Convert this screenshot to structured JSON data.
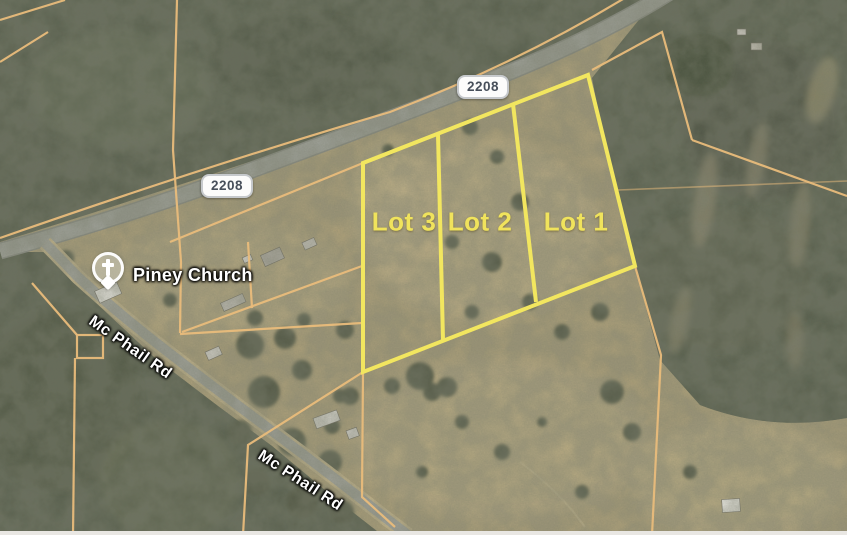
{
  "map": {
    "highway_badges": [
      {
        "label": "2208"
      },
      {
        "label": "2208"
      }
    ],
    "place": {
      "label": "Piney Church",
      "icon": "church-pin-icon"
    },
    "road_labels": [
      {
        "label": "Mc Phail Rd"
      },
      {
        "label": "Mc Phail Rd"
      }
    ],
    "lot_labels": [
      {
        "label": "Lot 3"
      },
      {
        "label": "Lot 2"
      },
      {
        "label": "Lot 1"
      }
    ],
    "colors": {
      "lot-line": "#f2e65f",
      "lot-text": "#f0e35c",
      "parcel-line": "#e9bc7b",
      "road-gray": "#a1a39b",
      "road-casing": "#8b8d85",
      "dirt-casing": "#c9b88d",
      "field-tan": "#b3a47c",
      "forest-dark": "#585d4a",
      "water-dark": "#47503a",
      "badge-text": "#474f5a",
      "badge-bg": "#fcfcfb",
      "label-white": "#ffffff"
    }
  }
}
